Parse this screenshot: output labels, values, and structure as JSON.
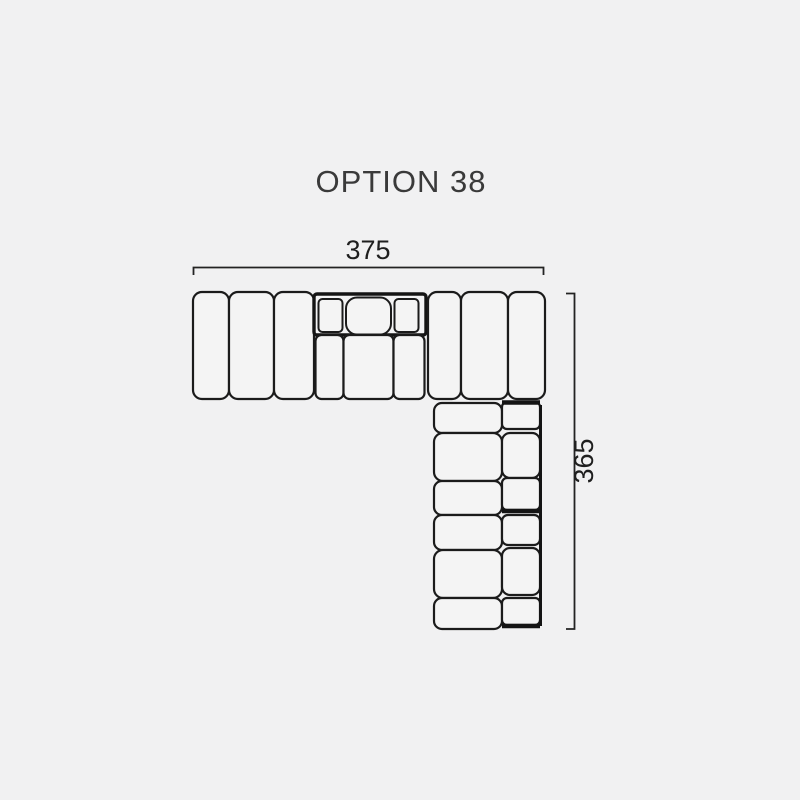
{
  "page": {
    "background_color": "#f1f1f2"
  },
  "title": "OPTION 38",
  "diagram": {
    "type": "sofa-configuration-plan",
    "description": "Top-view plan drawing of an L-shaped modular sofa",
    "line_color": "#1b1b1b",
    "module_fill": "#f4f4f4",
    "width_dimension": {
      "label": "375"
    },
    "height_dimension": {
      "label": "365"
    }
  }
}
